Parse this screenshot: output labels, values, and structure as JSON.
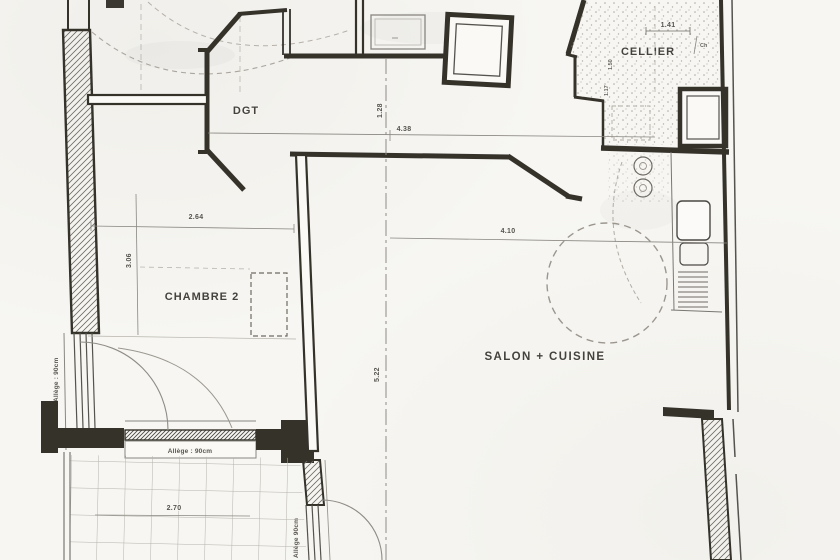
{
  "rooms": {
    "dgt": "DGT",
    "cellier": "CELLIER",
    "chambre2": "CHAMBRE 2",
    "salon": "SALON + CUISINE"
  },
  "dimensions": {
    "hall_width": "4.38",
    "hall_depth": "1.28",
    "cellier_width": "1.41",
    "cellier_mark": "Ch",
    "cellier_side_a": "1.50",
    "cellier_side_b": "1.17",
    "chambre_width": "2.64",
    "chambre_depth": "3.06",
    "salon_width": "4.10",
    "salon_depth": "5.22",
    "balcony_width": "2.70"
  },
  "annotations": {
    "allege_left": "Allège : 90cm",
    "allege_window": "Allège : 90cm",
    "allege_balcony": "Allège 90cm"
  },
  "colors": {
    "paper": "#f7f6f2",
    "ink": "#34312c",
    "pencil": "#8a8781",
    "text": "#45433e"
  }
}
